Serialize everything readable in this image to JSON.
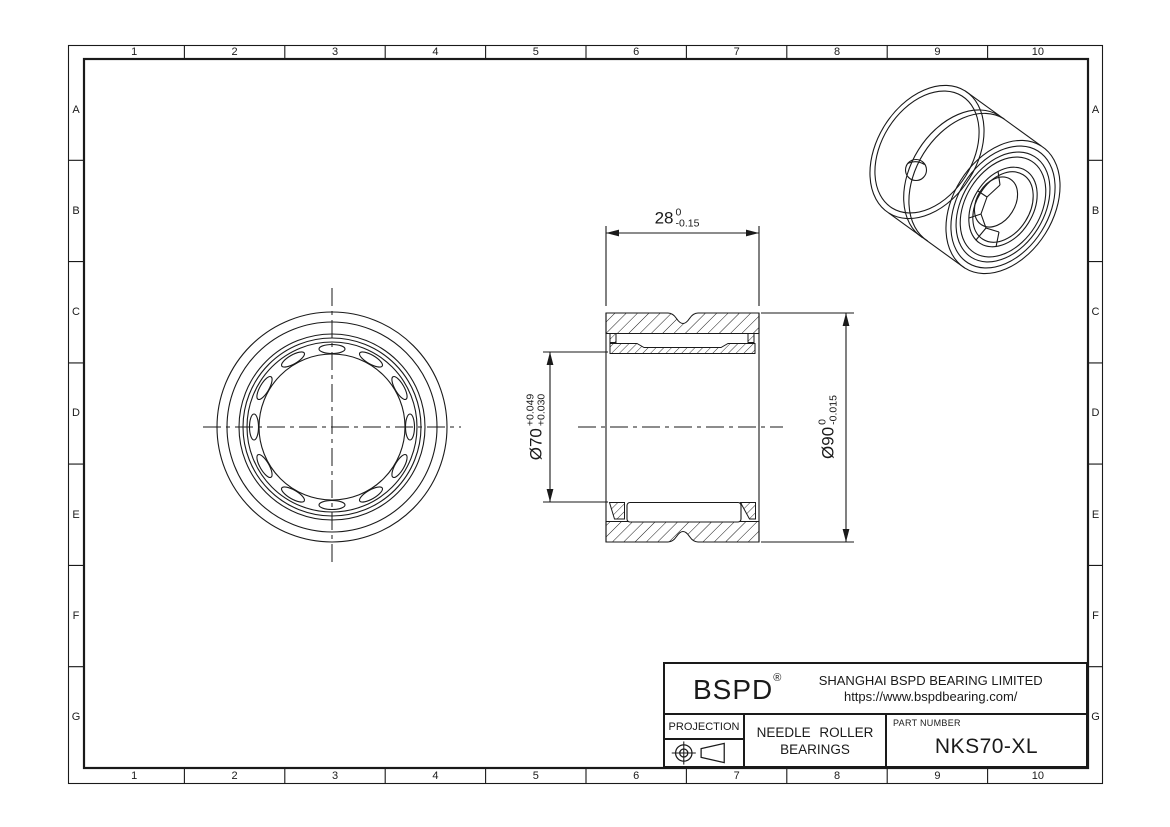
{
  "colors": {
    "background": "#ffffff",
    "line": "#1a1a1a"
  },
  "grid": {
    "cols": [
      "1",
      "2",
      "3",
      "4",
      "5",
      "6",
      "7",
      "8",
      "9",
      "10"
    ],
    "rows": [
      "A",
      "B",
      "C",
      "D",
      "E",
      "F",
      "G"
    ]
  },
  "dimensions": {
    "width": {
      "main": "28",
      "tol_top": "0",
      "tol_bottom": "-0.15"
    },
    "bore": {
      "main": "Ø70",
      "tol_top": "+0.049",
      "tol_bottom": "+0.030"
    },
    "outer": {
      "main": "Ø90",
      "tol_top": "0",
      "tol_bottom": "-0.015"
    }
  },
  "title_block": {
    "logo": "BSPD",
    "registered_mark": "®",
    "company": "SHANGHAI BSPD BEARING LIMITED",
    "website": "https://www.bspdbearing.com/",
    "projection_label": "PROJECTION",
    "product_line1": "NEEDLE ROLLER",
    "product_line2": "BEARINGS",
    "part_number_label": "PART NUMBER",
    "part_number": "NKS70-XL"
  },
  "icons": {
    "projection": "first-angle-projection-symbol"
  }
}
